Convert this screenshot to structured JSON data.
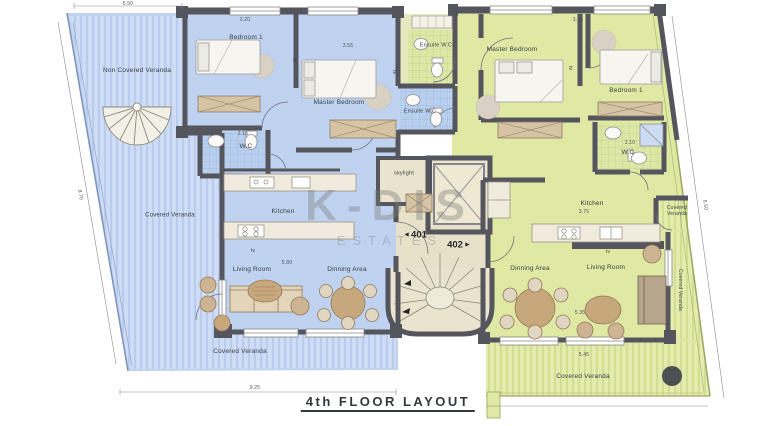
{
  "plan": {
    "title": "4th FLOOR LAYOUT",
    "watermark": {
      "name": "K-DIS",
      "sub": "ESTATES"
    },
    "units": {
      "left": {
        "number": "401",
        "color": "#bfd3f1"
      },
      "right": {
        "number": "402",
        "color": "#dfe9a3"
      }
    },
    "colors": {
      "wall": "#55555d",
      "core": "#eae3cd",
      "veranda_left": "#ccdbf4",
      "veranda_right": "#e3ecac",
      "furniture": "#c7a87c"
    },
    "rooms": {
      "left": {
        "non_covered_veranda": "Non Covered Veranda",
        "bedroom1": "Bedroom 1",
        "master_bedroom": "Master Bedroom",
        "wc": "W.C",
        "ensuite_wc": "Ensuite W.C",
        "kitchen": "Kitchen",
        "covered_veranda_side": "Covered Veranda",
        "living_room": "Living Room",
        "dinning_area": "Dinning Area",
        "covered_veranda_bottom": "Covered Veranda"
      },
      "right": {
        "ensuite_wc": "Ensuite W.C",
        "master_bedroom": "Master Bedroom",
        "bedroom1": "Bedroom 1",
        "wc": "W.C",
        "kitchen": "Kitchen",
        "covered_veranda_side": "Covered Veranda",
        "dinning_area": "Dinning Area",
        "living_room": "Living Room",
        "covered_veranda_bottom": "Covered Veranda",
        "covered_veranda_edge": "Covered Veranda"
      },
      "core": {
        "skylight": "skylight"
      }
    },
    "annotations": {
      "tv": "tv",
      "door_marker_left": "◄",
      "door_marker_right": "►"
    },
    "dims": {
      "top_left": "5.50",
      "bedroom1_left": "3.20",
      "master_left": "3.55",
      "bedroom1_right": "3.15",
      "wc_left": "2.15",
      "wc_right": "2.10",
      "living_left": "5.80",
      "dining_right": "5.35",
      "veranda_bottom_right": "5.45",
      "kitchen_right": "3.75",
      "bottom": "9.25",
      "edge_left": "8.70",
      "edge_right": "8.50"
    }
  }
}
